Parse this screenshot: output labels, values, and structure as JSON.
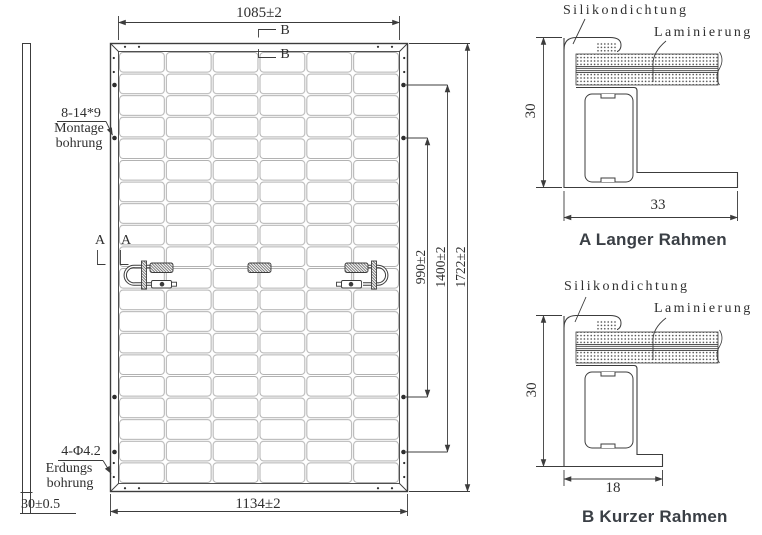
{
  "drawing": {
    "rear_view": {
      "dim_width_top": "1085±2",
      "dim_width_bottom": "1134±2",
      "dim_height_inner": "990±2",
      "dim_height_mid": "1400±2",
      "dim_height_outer": "1722±2",
      "dim_frame_side": "30±0.5",
      "mounting_hole_spec": "8-14*9",
      "mounting_hole_label1": "Montage",
      "mounting_hole_label2": "bohrung",
      "grounding_hole_spec": "4-Φ4.2",
      "grounding_hole_label1": "Erdungs",
      "grounding_hole_label2": "bohrung",
      "section_mark_a": "A",
      "section_mark_b": "B"
    },
    "detail_long_frame": {
      "caption": "A Langer Rahmen",
      "label_seal": "Silikondichtung",
      "label_lamination": "Laminierung",
      "dim_height": "30",
      "dim_width": "33"
    },
    "detail_short_frame": {
      "caption": "B Kurzer Rahmen",
      "label_seal": "Silikondichtung",
      "label_lamination": "Laminierung",
      "dim_height": "30",
      "dim_width": "18"
    }
  }
}
